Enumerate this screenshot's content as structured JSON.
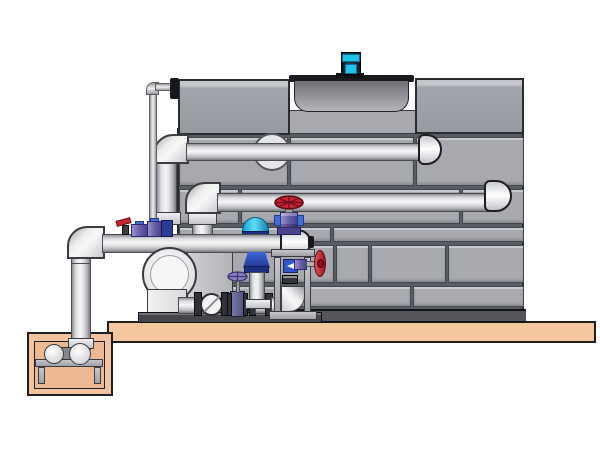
{
  "title": "Cooling tower, pump skid and sump pit piping — technical illustration (no on-screen text)",
  "colors": {
    "bg": "#ffffff",
    "outline": "#1d1e22",
    "seam": "#5a5c63",
    "towerPanel": "#a7a9af",
    "towerBase": "#54565c",
    "towerEdge": "#2b2c30",
    "boxGray": "#a3a5ac",
    "boxLight": "#c5c7cc",
    "cowlTop": "#6e7076",
    "cowlBottom": "#b4b6ba",
    "rim": "#191a1d",
    "motorBody": "#16222e",
    "cyan": "#1fc3ea",
    "pipeEdge": "#4a4c52",
    "slab": "#f5c79f",
    "pitWall": "#f3c3a0",
    "pitInner": "#edb993",
    "steelLight": "#c6c7cb",
    "steelDark": "#44464c",
    "steelEdge": "#3a3c41",
    "red": "#c92433",
    "redDark": "#731019",
    "purple": "#7a6fb6",
    "purpleDark": "#4a438e",
    "blue": "#2f55c8",
    "navy": "#2c3c92"
  },
  "components": [
    {
      "id": "platform-slab",
      "label": "concrete platform slab"
    },
    {
      "id": "sump-pit",
      "label": "below-grade sump pit"
    },
    {
      "id": "sump-pump",
      "label": "horizontal pump in sump pit on stand"
    },
    {
      "id": "suction-riser",
      "label": "vertical suction riser from sump"
    },
    {
      "id": "suction-header",
      "label": "horizontal suction header pipe"
    },
    {
      "id": "cooling-tower",
      "label": "cooling tower with paneled casing"
    },
    {
      "id": "fan-cowl",
      "label": "fan cowl on tower roof"
    },
    {
      "id": "fan-motor",
      "label": "cyan fan motor on cowl"
    },
    {
      "id": "tower-return-pipe-upper",
      "label": "upper return pipe into tower"
    },
    {
      "id": "tower-return-pipe-lower",
      "label": "lower return pipe into tower"
    },
    {
      "id": "makeup-line",
      "label": "thin make-up water line to tower top box"
    },
    {
      "id": "centrifugal-pump",
      "label": "end-suction centrifugal pump on skid"
    },
    {
      "id": "check-valve",
      "label": "wafer check valve on skid line"
    },
    {
      "id": "gate-valve",
      "label": "gate valve with small handwheel"
    },
    {
      "id": "control-valve",
      "label": "control valve with cyan dome actuator"
    },
    {
      "id": "globe-valve",
      "label": "globe valve with red handwheel"
    },
    {
      "id": "side-valve",
      "label": "red handwheel valve on meter stand"
    },
    {
      "id": "flow-meter",
      "label": "blue flow meter in stand"
    },
    {
      "id": "mini-valves",
      "label": "small purple isolation valves on header"
    }
  ]
}
